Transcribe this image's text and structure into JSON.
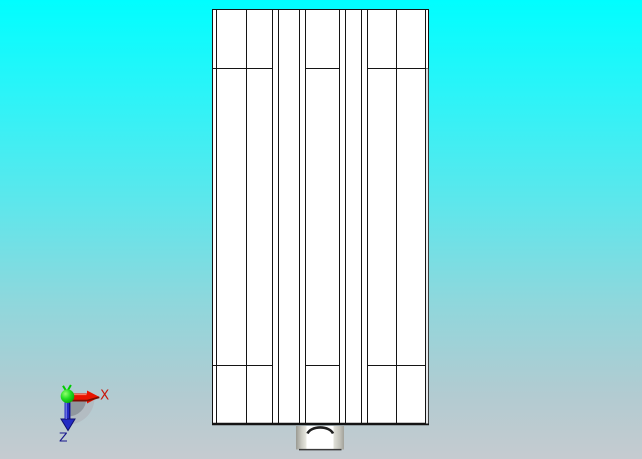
{
  "viewport": {
    "background": {
      "top_color": "#00feff",
      "bottom_color": "#c5cbd0"
    },
    "part": {
      "description": "white extruded rectangular profile, front orthographic view, with bottom center foot boss",
      "fill": "#ffffff",
      "line_color": "#141414",
      "outline": {
        "x": 212,
        "y": 9,
        "width": 217,
        "height": 416
      },
      "vertical_edges_x": [
        216,
        246,
        272,
        278,
        299,
        305,
        339,
        345,
        361,
        367,
        396,
        425
      ],
      "horizontal_edge_y": [
        68,
        365
      ],
      "horizontal_segments_x": [
        [
          212,
          272
        ],
        [
          305,
          339
        ],
        [
          367,
          429
        ]
      ],
      "bottom_edge_thickness": 2.4
    },
    "triad": {
      "x_label": "X",
      "z_label": "Z",
      "x_axis_color": "#e81400",
      "y_axis_color": "#00cc00",
      "z_axis_color": "#232bc4",
      "x_label_color": "#c8170c",
      "z_label_color": "#16168c",
      "shadow_inner_color": "#8e959c",
      "shadow_outer_color": "#b2b8be"
    }
  }
}
